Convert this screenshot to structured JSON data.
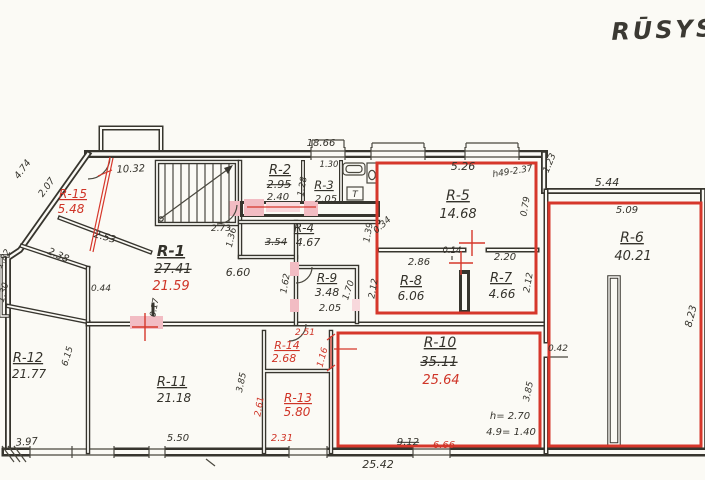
{
  "title": "RŪSYS",
  "colors": {
    "ink": "#37352e",
    "red": "#cf3427",
    "pink": "#f2bcc3",
    "paper": "#fbfaf5"
  },
  "labels": [
    {
      "n": "dim-top-18-66",
      "t": "18.66",
      "x": 321,
      "y": 146,
      "fs": 10
    },
    {
      "n": "dim-10-32",
      "t": "10.32",
      "x": 131,
      "y": 172,
      "fs": 10,
      "rot": -3
    },
    {
      "n": "dim-4-74",
      "t": "4.74",
      "x": 25,
      "y": 171,
      "fs": 9.5,
      "rot": -54
    },
    {
      "n": "dim-2-07",
      "t": "2.07",
      "x": 49,
      "y": 189,
      "fs": 9.5,
      "rot": -54
    },
    {
      "n": "dim-2-53",
      "t": "2.53",
      "x": 104,
      "y": 240,
      "fs": 10,
      "rot": 16
    },
    {
      "n": "dim-2-38",
      "t": "2.38",
      "x": 57,
      "y": 258,
      "fs": 10,
      "rot": 24
    },
    {
      "n": "dim-1-82",
      "t": "1.82",
      "x": 6,
      "y": 260,
      "fs": 9,
      "rot": -62
    },
    {
      "n": "dim-1-30-left",
      "t": "1.30",
      "x": 6,
      "y": 293,
      "fs": 9,
      "rot": -76
    },
    {
      "n": "dim-2-73",
      "t": "2.73",
      "x": 221,
      "y": 231,
      "fs": 9
    },
    {
      "n": "dim-6-60",
      "t": "6.60",
      "x": 238,
      "y": 276,
      "fs": 11
    },
    {
      "n": "dim-1-36",
      "t": "1.36",
      "x": 234,
      "y": 238,
      "fs": 9,
      "rot": -77
    },
    {
      "n": "dim-3-54",
      "t": "3.54",
      "x": 276,
      "y": 245,
      "fs": 10,
      "cls": "strike"
    },
    {
      "n": "dim-1-39",
      "t": "1.39",
      "x": 371,
      "y": 233,
      "fs": 9,
      "rot": -80
    },
    {
      "n": "dim-1-28",
      "t": "1.28",
      "x": 305,
      "y": 187,
      "fs": 9,
      "rot": -80
    },
    {
      "n": "dim-1-30-r3",
      "t": "1.30",
      "x": 329,
      "y": 167,
      "fs": 8.5
    },
    {
      "n": "dim-1-62",
      "t": "1.62",
      "x": 288,
      "y": 284,
      "fs": 9,
      "rot": -80
    },
    {
      "n": "dim-1-70",
      "t": "1.70",
      "x": 351,
      "y": 291,
      "fs": 9,
      "rot": -72
    },
    {
      "n": "dim-5-26",
      "t": "5.26",
      "x": 463,
      "y": 170,
      "fs": 11
    },
    {
      "n": "note-height-r5",
      "t": "h49-2.37",
      "x": 513,
      "y": 174,
      "fs": 9,
      "rot": -9
    },
    {
      "n": "dim-0-79",
      "t": "0.79",
      "x": 528,
      "y": 207,
      "fs": 9,
      "rot": -80
    },
    {
      "n": "dim-0-34",
      "t": "0.34",
      "x": 384,
      "y": 227,
      "fs": 9,
      "rot": -42
    },
    {
      "n": "dim-0-14",
      "t": "0.14",
      "x": 452,
      "y": 253,
      "fs": 8.5
    },
    {
      "n": "dim-2-86",
      "t": "2.86",
      "x": 419,
      "y": 265,
      "fs": 10
    },
    {
      "n": "dim-2-20",
      "t": "2.20",
      "x": 505,
      "y": 260,
      "fs": 10
    },
    {
      "n": "dim-2-12-left",
      "t": "2.12",
      "x": 376,
      "y": 289,
      "fs": 9,
      "rot": -80
    },
    {
      "n": "dim-2-12-right",
      "t": "2.12",
      "x": 531,
      "y": 283,
      "fs": 9,
      "rot": -80
    },
    {
      "n": "dim-1-23",
      "t": "1.23",
      "x": 552,
      "y": 164,
      "fs": 9,
      "rot": -68
    },
    {
      "n": "dim-5-44",
      "t": "5.44",
      "x": 607,
      "y": 186,
      "fs": 11
    },
    {
      "n": "dim-5-09",
      "t": "5.09",
      "x": 627,
      "y": 213,
      "fs": 10
    },
    {
      "n": "dim-8-23",
      "t": "8.23",
      "x": 694,
      "y": 317,
      "fs": 10,
      "rot": -76
    },
    {
      "n": "dim-0-42",
      "t": "0.42",
      "x": 558,
      "y": 351,
      "fs": 9
    },
    {
      "n": "dim-3-85-r6",
      "t": "3.85",
      "x": 531,
      "y": 392,
      "fs": 9,
      "rot": -78
    },
    {
      "n": "dim-0-17",
      "t": "0.17",
      "x": 157,
      "y": 308,
      "fs": 8.5,
      "rot": -80
    },
    {
      "n": "dim-0-44",
      "t": "0.44",
      "x": 101,
      "y": 291,
      "fs": 9
    },
    {
      "n": "dim-6-15",
      "t": "6.15",
      "x": 70,
      "y": 357,
      "fs": 9,
      "rot": -73
    },
    {
      "n": "dim-3-97",
      "t": "3.97",
      "x": 27,
      "y": 445,
      "fs": 10,
      "rot": -4
    },
    {
      "n": "dim-5-50",
      "t": "5.50",
      "x": 178,
      "y": 441,
      "fs": 10
    },
    {
      "n": "dim-3-85-r11",
      "t": "3.85",
      "x": 244,
      "y": 383,
      "fs": 9,
      "rot": -78
    },
    {
      "n": "dim-9-12",
      "t": "9.12",
      "x": 408,
      "y": 445,
      "fs": 10,
      "cls": "strike"
    },
    {
      "n": "dim-6-66",
      "t": "6.66",
      "x": 444,
      "y": 448,
      "fs": 10,
      "cls": "red"
    },
    {
      "n": "dim-25-42",
      "t": "25.42",
      "x": 378,
      "y": 468,
      "fs": 11
    },
    {
      "n": "note-h-2-70",
      "t": "h= 2.70",
      "x": 510,
      "y": 419,
      "fs": 10
    },
    {
      "n": "note-4-9-1-40",
      "t": "4.9= 1.40",
      "x": 511,
      "y": 435,
      "fs": 10
    },
    {
      "n": "room-r1-name",
      "t": "R-1",
      "x": 171,
      "y": 256,
      "fs": 15,
      "cls": "u b"
    },
    {
      "n": "room-r1-area-old",
      "t": "27.41",
      "x": 173,
      "y": 273,
      "fs": 13,
      "cls": "strike"
    },
    {
      "n": "room-r1-area-new",
      "t": "21.59",
      "x": 171,
      "y": 290,
      "fs": 13,
      "cls": "red"
    },
    {
      "n": "room-r2-name",
      "t": "R-2",
      "x": 280,
      "y": 174,
      "fs": 13,
      "cls": "u"
    },
    {
      "n": "room-r2-area-old",
      "t": "2.95",
      "x": 279,
      "y": 188,
      "fs": 11,
      "cls": "strike"
    },
    {
      "n": "room-r2-area-new",
      "t": "2.40",
      "x": 278,
      "y": 200,
      "fs": 10
    },
    {
      "n": "room-r3-name",
      "t": "R-3",
      "x": 324,
      "y": 189,
      "fs": 11.5,
      "cls": "u"
    },
    {
      "n": "room-r3-area",
      "t": "2.05",
      "x": 326,
      "y": 202,
      "fs": 10
    },
    {
      "n": "fixture-t-glyph",
      "t": "T",
      "x": 355,
      "y": 197,
      "fs": 9
    },
    {
      "n": "room-r4-name",
      "t": "R-4",
      "x": 304,
      "y": 232,
      "fs": 12,
      "cls": "u"
    },
    {
      "n": "room-r4-area",
      "t": "4.67",
      "x": 308,
      "y": 246,
      "fs": 11
    },
    {
      "n": "room-r9-name",
      "t": "R-9",
      "x": 327,
      "y": 282,
      "fs": 12,
      "cls": "u"
    },
    {
      "n": "room-r9-area",
      "t": "3.48",
      "x": 327,
      "y": 296,
      "fs": 11
    },
    {
      "n": "room-r9-dim",
      "t": "2.05",
      "x": 330,
      "y": 311,
      "fs": 10
    },
    {
      "n": "room-r5-name",
      "t": "R-5",
      "x": 458,
      "y": 200,
      "fs": 14,
      "cls": "u"
    },
    {
      "n": "room-r5-area",
      "t": "14.68",
      "x": 458,
      "y": 218,
      "fs": 13
    },
    {
      "n": "room-r8-name",
      "t": "R-8",
      "x": 411,
      "y": 285,
      "fs": 13,
      "cls": "u"
    },
    {
      "n": "room-r8-area",
      "t": "6.06",
      "x": 411,
      "y": 300,
      "fs": 12
    },
    {
      "n": "room-r7-name",
      "t": "R-7",
      "x": 501,
      "y": 282,
      "fs": 13,
      "cls": "u"
    },
    {
      "n": "room-r7-area",
      "t": "4.66",
      "x": 502,
      "y": 298,
      "fs": 12
    },
    {
      "n": "room-r6-name",
      "t": "R-6",
      "x": 632,
      "y": 242,
      "fs": 14,
      "cls": "u"
    },
    {
      "n": "room-r6-area",
      "t": "40.21",
      "x": 633,
      "y": 260,
      "fs": 13
    },
    {
      "n": "room-r10-name",
      "t": "R-10",
      "x": 440,
      "y": 347,
      "fs": 14,
      "cls": "u"
    },
    {
      "n": "room-r10-area-old",
      "t": "35.11",
      "x": 439,
      "y": 366,
      "fs": 13,
      "cls": "strike"
    },
    {
      "n": "room-r10-area-new",
      "t": "25.64",
      "x": 441,
      "y": 384,
      "fs": 13,
      "cls": "red"
    },
    {
      "n": "room-r11-name",
      "t": "R-11",
      "x": 172,
      "y": 386,
      "fs": 13,
      "cls": "u"
    },
    {
      "n": "room-r11-area",
      "t": "21.18",
      "x": 174,
      "y": 402,
      "fs": 12
    },
    {
      "n": "room-r12-name",
      "t": "R-12",
      "x": 28,
      "y": 362,
      "fs": 13,
      "cls": "u"
    },
    {
      "n": "room-r12-area",
      "t": "21.77",
      "x": 29,
      "y": 378,
      "fs": 12
    },
    {
      "n": "room-r15-name",
      "t": "R-15",
      "x": 73,
      "y": 198,
      "fs": 12,
      "cls": "red u"
    },
    {
      "n": "room-r15-area",
      "t": "5.48",
      "x": 71,
      "y": 213,
      "fs": 12,
      "cls": "red"
    },
    {
      "n": "room-r14-name",
      "t": "R-14",
      "x": 287,
      "y": 349,
      "fs": 11,
      "cls": "red u"
    },
    {
      "n": "room-r14-area",
      "t": "2.68",
      "x": 284,
      "y": 362,
      "fs": 11,
      "cls": "red"
    },
    {
      "n": "dim-2-51",
      "t": "2.51",
      "x": 305,
      "y": 335,
      "fs": 9,
      "cls": "red"
    },
    {
      "n": "dim-1-16",
      "t": "1.16",
      "x": 325,
      "y": 358,
      "fs": 9,
      "rot": -75,
      "cls": "red"
    },
    {
      "n": "room-r13-name",
      "t": "R-13",
      "x": 298,
      "y": 402,
      "fs": 12,
      "cls": "red u"
    },
    {
      "n": "room-r13-area",
      "t": "5.80",
      "x": 297,
      "y": 416,
      "fs": 12,
      "cls": "red"
    },
    {
      "n": "dim-2-61",
      "t": "2.61",
      "x": 262,
      "y": 407,
      "fs": 9,
      "rot": -80,
      "cls": "red"
    },
    {
      "n": "dim-2-31",
      "t": "2.31",
      "x": 282,
      "y": 441,
      "fs": 10,
      "cls": "red"
    }
  ]
}
